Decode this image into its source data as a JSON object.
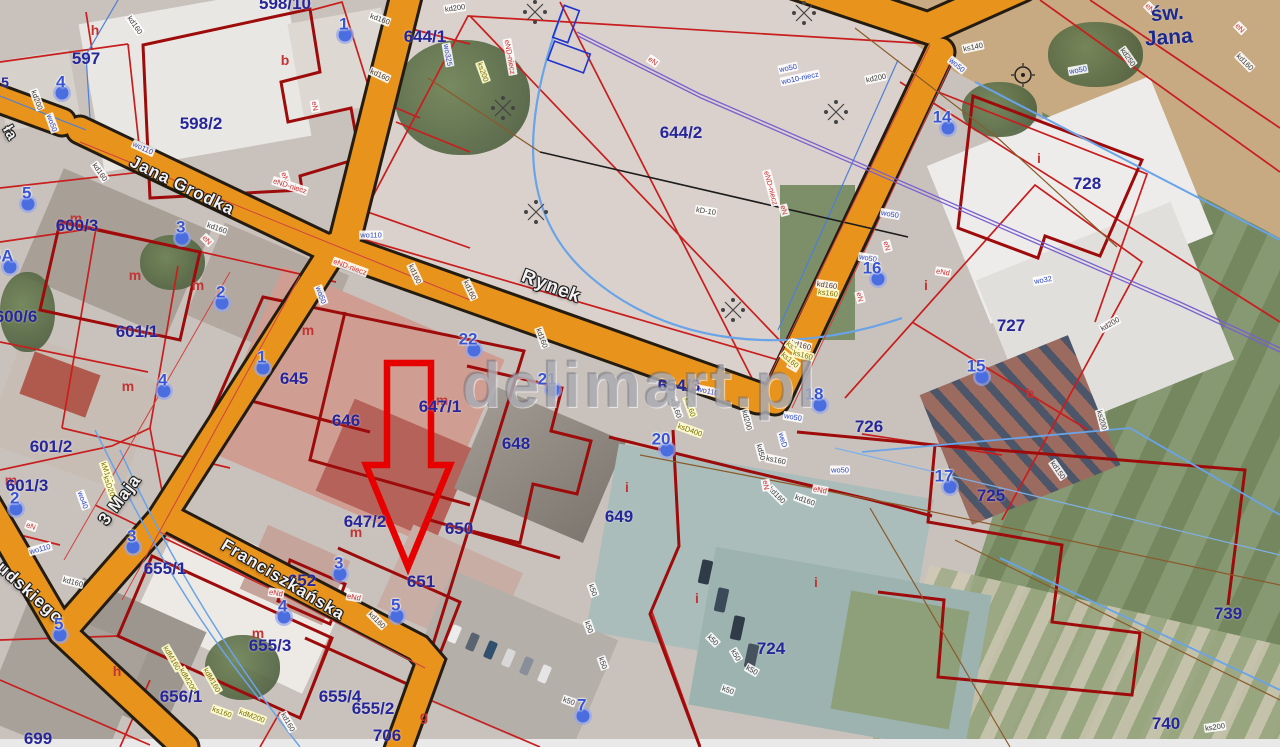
{
  "watermark": "delimart.pl",
  "colors": {
    "road": "#E8941C",
    "road-casing": "#241c10",
    "parcel": "#C81E1E",
    "parcel-dark": "#9E0B0B",
    "parcel-text": "#26269A",
    "marker": "#4a6ee0",
    "marker-text": "#3A55D4",
    "street-text": "#F2F2F2",
    "arrow": "#E60000",
    "letter": "#C23535",
    "watermark": "rgba(135,137,148,0.5)"
  },
  "streets": [
    {
      "t": "Jana Grodka",
      "x": 182,
      "y": 186,
      "r": 26,
      "s": 17,
      "k": "road"
    },
    {
      "t": "Rynek",
      "x": 551,
      "y": 287,
      "r": 21,
      "s": 19,
      "k": "road"
    },
    {
      "t": "3 Maja",
      "x": 120,
      "y": 500,
      "r": -53,
      "s": 17,
      "k": "road"
    },
    {
      "t": "Franciszkańska",
      "x": 283,
      "y": 580,
      "r": 31,
      "s": 17,
      "k": "road"
    },
    {
      "t": "udskiego",
      "x": 30,
      "y": 593,
      "r": 42,
      "s": 17,
      "k": "road"
    },
    {
      "t": "ła",
      "x": 10,
      "y": 133,
      "r": 60,
      "s": 15,
      "k": "road"
    },
    {
      "t": "św.\nJana",
      "x": 1168,
      "y": 26,
      "r": -4,
      "s": 21,
      "k": "navy"
    }
  ],
  "parcels": [
    {
      "t": "597",
      "x": 86,
      "y": 59
    },
    {
      "t": "598/2",
      "x": 201,
      "y": 124
    },
    {
      "t": "598/10",
      "x": 285,
      "y": 4
    },
    {
      "t": "600/3",
      "x": 77,
      "y": 226
    },
    {
      "t": "600/6",
      "x": 16,
      "y": 317
    },
    {
      "t": "601/1",
      "x": 137,
      "y": 332
    },
    {
      "t": "601/2",
      "x": 51,
      "y": 447
    },
    {
      "t": "601/3",
      "x": 27,
      "y": 486
    },
    {
      "t": "645",
      "x": 294,
      "y": 379
    },
    {
      "t": "646",
      "x": 346,
      "y": 421
    },
    {
      "t": "644/2",
      "x": 681,
      "y": 133
    },
    {
      "t": "644/1",
      "x": 425,
      "y": 37
    },
    {
      "t": "654/3",
      "x": 679,
      "y": 386
    },
    {
      "t": "647/1",
      "x": 440,
      "y": 407
    },
    {
      "t": "648",
      "x": 516,
      "y": 444
    },
    {
      "t": "647/2",
      "x": 365,
      "y": 522
    },
    {
      "t": "650",
      "x": 459,
      "y": 529
    },
    {
      "t": "651",
      "x": 421,
      "y": 582
    },
    {
      "t": "649",
      "x": 619,
      "y": 517
    },
    {
      "t": "652",
      "x": 302,
      "y": 581
    },
    {
      "t": "655/1",
      "x": 165,
      "y": 569
    },
    {
      "t": "655/3",
      "x": 270,
      "y": 646
    },
    {
      "t": "655/4",
      "x": 340,
      "y": 697
    },
    {
      "t": "655/2",
      "x": 373,
      "y": 709
    },
    {
      "t": "656/1",
      "x": 181,
      "y": 697
    },
    {
      "t": "699",
      "x": 38,
      "y": 739
    },
    {
      "t": "706",
      "x": 387,
      "y": 736
    },
    {
      "t": "724",
      "x": 771,
      "y": 649
    },
    {
      "t": "725",
      "x": 991,
      "y": 496
    },
    {
      "t": "726",
      "x": 869,
      "y": 427
    },
    {
      "t": "727",
      "x": 1011,
      "y": 326
    },
    {
      "t": "728",
      "x": 1087,
      "y": 184
    },
    {
      "t": "739",
      "x": 1228,
      "y": 614
    },
    {
      "t": "740",
      "x": 1166,
      "y": 724
    },
    {
      "t": "5",
      "x": 5,
      "y": 82,
      "s": 14
    }
  ],
  "markers": [
    {
      "n": "1",
      "x": 345,
      "y": 35
    },
    {
      "n": "4",
      "x": 62,
      "y": 93
    },
    {
      "n": "5",
      "x": 28,
      "y": 204
    },
    {
      "n": "5A",
      "x": 10,
      "y": 267
    },
    {
      "n": "3",
      "x": 182,
      "y": 238
    },
    {
      "n": "2",
      "x": 222,
      "y": 303
    },
    {
      "n": "4",
      "x": 164,
      "y": 391
    },
    {
      "n": "1",
      "x": 263,
      "y": 368
    },
    {
      "n": "2",
      "x": 16,
      "y": 509
    },
    {
      "n": "3",
      "x": 133,
      "y": 547
    },
    {
      "n": "5",
      "x": 60,
      "y": 635
    },
    {
      "n": "3",
      "x": 340,
      "y": 574
    },
    {
      "n": "4",
      "x": 284,
      "y": 617
    },
    {
      "n": "5",
      "x": 397,
      "y": 616
    },
    {
      "n": "22",
      "x": 474,
      "y": 350
    },
    {
      "n": "21",
      "x": 553,
      "y": 390
    },
    {
      "n": "20",
      "x": 667,
      "y": 450
    },
    {
      "n": "18",
      "x": 820,
      "y": 405
    },
    {
      "n": "16",
      "x": 878,
      "y": 279
    },
    {
      "n": "14",
      "x": 948,
      "y": 128
    },
    {
      "n": "15",
      "x": 982,
      "y": 377
    },
    {
      "n": "17",
      "x": 950,
      "y": 487
    },
    {
      "n": "7",
      "x": 583,
      "y": 716
    }
  ],
  "letters": [
    {
      "t": "h",
      "x": 95,
      "y": 30
    },
    {
      "t": "b",
      "x": 285,
      "y": 60
    },
    {
      "t": "m",
      "x": 76,
      "y": 218
    },
    {
      "t": "m",
      "x": 135,
      "y": 275
    },
    {
      "t": "m",
      "x": 198,
      "y": 285
    },
    {
      "t": "m",
      "x": 308,
      "y": 330
    },
    {
      "t": "m",
      "x": 128,
      "y": 386
    },
    {
      "t": "m",
      "x": 442,
      "y": 400
    },
    {
      "t": "b",
      "x": 1030,
      "y": 393
    },
    {
      "t": "i",
      "x": 1039,
      "y": 158
    },
    {
      "t": "i",
      "x": 926,
      "y": 285
    },
    {
      "t": "i",
      "x": 627,
      "y": 487
    },
    {
      "t": "i",
      "x": 697,
      "y": 598
    },
    {
      "t": "i",
      "x": 816,
      "y": 582
    },
    {
      "t": "m",
      "x": 356,
      "y": 532
    },
    {
      "t": "m",
      "x": 258,
      "y": 633
    },
    {
      "t": "h",
      "x": 117,
      "y": 671
    },
    {
      "t": "g",
      "x": 424,
      "y": 716
    },
    {
      "t": "m",
      "x": 11,
      "y": 480
    }
  ],
  "utilities": [
    {
      "t": "kd200",
      "x": 455,
      "y": 8,
      "r": -8,
      "c": "d"
    },
    {
      "t": "kd160",
      "x": 135,
      "y": 25,
      "r": 55,
      "c": "d"
    },
    {
      "t": "kd160",
      "x": 380,
      "y": 19,
      "r": 20,
      "c": "d"
    },
    {
      "t": "kd160",
      "x": 380,
      "y": 75,
      "r": 25,
      "c": "d"
    },
    {
      "t": "kd200",
      "x": 37,
      "y": 100,
      "r": 70,
      "c": "d"
    },
    {
      "t": "kd160",
      "x": 100,
      "y": 172,
      "r": 55,
      "c": "d"
    },
    {
      "t": "kd160",
      "x": 217,
      "y": 228,
      "r": 20,
      "c": "d"
    },
    {
      "t": "kd160",
      "x": 415,
      "y": 274,
      "r": 65,
      "c": "d"
    },
    {
      "t": "kd160",
      "x": 470,
      "y": 290,
      "r": 65,
      "c": "d"
    },
    {
      "t": "kd160",
      "x": 542,
      "y": 338,
      "r": 70,
      "c": "d"
    },
    {
      "t": "kD-10",
      "x": 706,
      "y": 211,
      "r": 9,
      "c": "d"
    },
    {
      "t": "kd200",
      "x": 876,
      "y": 78,
      "r": -12,
      "c": "d"
    },
    {
      "t": "ks140",
      "x": 973,
      "y": 47,
      "r": -12,
      "c": "d"
    },
    {
      "t": "kd250",
      "x": 1128,
      "y": 57,
      "r": 55,
      "c": "d"
    },
    {
      "t": "kd160",
      "x": 1245,
      "y": 62,
      "r": 45,
      "c": "d"
    },
    {
      "t": "kd200",
      "x": 1110,
      "y": 324,
      "r": -30,
      "c": "d"
    },
    {
      "t": "ks200",
      "x": 1102,
      "y": 420,
      "r": 75,
      "c": "d"
    },
    {
      "t": "kd150",
      "x": 1058,
      "y": 470,
      "r": 55,
      "c": "d"
    },
    {
      "t": "ks200",
      "x": 1215,
      "y": 727,
      "r": -8,
      "c": "d"
    },
    {
      "t": "kd160",
      "x": 676,
      "y": 408,
      "r": 70,
      "c": "d"
    },
    {
      "t": "kd200",
      "x": 747,
      "y": 420,
      "r": 75,
      "c": "d"
    },
    {
      "t": "kd160",
      "x": 805,
      "y": 500,
      "r": 20,
      "c": "d"
    },
    {
      "t": "kd160",
      "x": 827,
      "y": 285,
      "r": 8,
      "c": "d"
    },
    {
      "t": "kd160",
      "x": 801,
      "y": 345,
      "r": 15,
      "c": "d"
    },
    {
      "t": "kd50",
      "x": 761,
      "y": 452,
      "r": 75,
      "c": "d"
    },
    {
      "t": "kd160",
      "x": 377,
      "y": 620,
      "r": 45,
      "c": "d"
    },
    {
      "t": "kd160",
      "x": 73,
      "y": 582,
      "r": 15,
      "c": "d"
    },
    {
      "t": "kd160",
      "x": 288,
      "y": 722,
      "r": 60,
      "c": "d"
    },
    {
      "t": "kd160",
      "x": 777,
      "y": 495,
      "r": 45,
      "c": "d"
    },
    {
      "t": "ks160",
      "x": 776,
      "y": 460,
      "r": 12,
      "c": "d"
    },
    {
      "t": "k50",
      "x": 593,
      "y": 590,
      "r": 70,
      "c": "d"
    },
    {
      "t": "k50",
      "x": 589,
      "y": 627,
      "r": 70,
      "c": "d"
    },
    {
      "t": "k50",
      "x": 603,
      "y": 663,
      "r": 70,
      "c": "d"
    },
    {
      "t": "k50",
      "x": 569,
      "y": 701,
      "r": 20,
      "c": "d"
    },
    {
      "t": "k50",
      "x": 713,
      "y": 640,
      "r": 45,
      "c": "d"
    },
    {
      "t": "k50",
      "x": 736,
      "y": 655,
      "r": 60,
      "c": "d"
    },
    {
      "t": "k50",
      "x": 752,
      "y": 670,
      "r": 30,
      "c": "d"
    },
    {
      "t": "k50",
      "x": 728,
      "y": 690,
      "r": 20,
      "c": "d"
    },
    {
      "t": "eN",
      "x": 315,
      "y": 106,
      "r": 80,
      "c": "r"
    },
    {
      "t": "eN",
      "x": 285,
      "y": 177,
      "r": 75,
      "c": "r"
    },
    {
      "t": "eND-niecz",
      "x": 290,
      "y": 186,
      "r": 18,
      "c": "r"
    },
    {
      "t": "eN",
      "x": 207,
      "y": 240,
      "r": 45,
      "c": "r"
    },
    {
      "t": "eND-niecz",
      "x": 510,
      "y": 57,
      "r": 80,
      "c": "r"
    },
    {
      "t": "eN",
      "x": 653,
      "y": 61,
      "r": 35,
      "c": "r"
    },
    {
      "t": "eND-niecz",
      "x": 771,
      "y": 188,
      "r": 75,
      "c": "r"
    },
    {
      "t": "eN",
      "x": 784,
      "y": 210,
      "r": 75,
      "c": "r"
    },
    {
      "t": "eND-niecz",
      "x": 350,
      "y": 267,
      "r": 20,
      "c": "r"
    },
    {
      "t": "eN",
      "x": 887,
      "y": 246,
      "r": 75,
      "c": "r"
    },
    {
      "t": "eN",
      "x": 860,
      "y": 297,
      "r": 75,
      "c": "r"
    },
    {
      "t": "eN",
      "x": 793,
      "y": 366,
      "r": 30,
      "c": "r"
    },
    {
      "t": "eNd",
      "x": 943,
      "y": 272,
      "r": 10,
      "c": "r"
    },
    {
      "t": "eN",
      "x": 1240,
      "y": 28,
      "r": 45,
      "c": "r"
    },
    {
      "t": "eN",
      "x": 1150,
      "y": 8,
      "r": 45,
      "c": "r"
    },
    {
      "t": "eNd",
      "x": 276,
      "y": 593,
      "r": 10,
      "c": "r"
    },
    {
      "t": "eNd",
      "x": 354,
      "y": 597,
      "r": 10,
      "c": "r"
    },
    {
      "t": "eN",
      "x": 31,
      "y": 526,
      "r": 20,
      "c": "r"
    },
    {
      "t": "eNd",
      "x": 820,
      "y": 490,
      "r": 10,
      "c": "r"
    },
    {
      "t": "eN",
      "x": 766,
      "y": 485,
      "r": 80,
      "c": "r"
    },
    {
      "t": "wo110",
      "x": 143,
      "y": 148,
      "r": 25,
      "c": "b"
    },
    {
      "t": "wo50",
      "x": 52,
      "y": 123,
      "r": 70,
      "c": "b"
    },
    {
      "t": "wo110",
      "x": 371,
      "y": 235,
      "r": 0,
      "c": "b"
    },
    {
      "t": "wo50",
      "x": 321,
      "y": 295,
      "r": 70,
      "c": "b"
    },
    {
      "t": "wo50",
      "x": 788,
      "y": 68,
      "r": -12,
      "c": "b"
    },
    {
      "t": "wo10-niecz",
      "x": 800,
      "y": 78,
      "r": -12,
      "c": "b"
    },
    {
      "t": "wo110",
      "x": 708,
      "y": 391,
      "r": 12,
      "c": "b"
    },
    {
      "t": "wo50",
      "x": 793,
      "y": 417,
      "r": 10,
      "c": "b"
    },
    {
      "t": "weD",
      "x": 783,
      "y": 440,
      "r": 75,
      "c": "b"
    },
    {
      "t": "wo50",
      "x": 890,
      "y": 214,
      "r": 10,
      "c": "b"
    },
    {
      "t": "wo50",
      "x": 868,
      "y": 258,
      "r": 10,
      "c": "b"
    },
    {
      "t": "wo50",
      "x": 1078,
      "y": 70,
      "r": -10,
      "c": "b"
    },
    {
      "t": "wo32",
      "x": 1043,
      "y": 280,
      "r": -10,
      "c": "b"
    },
    {
      "t": "wo110",
      "x": 40,
      "y": 549,
      "r": -15,
      "c": "b"
    },
    {
      "t": "wo40",
      "x": 83,
      "y": 500,
      "r": 70,
      "c": "b"
    },
    {
      "t": "wo50",
      "x": 840,
      "y": 470,
      "r": 0,
      "c": "b"
    },
    {
      "t": "wo50",
      "x": 957,
      "y": 65,
      "r": 40,
      "c": "b"
    },
    {
      "t": "wo325",
      "x": 448,
      "y": 55,
      "r": 80,
      "c": "b"
    },
    {
      "t": "ks200",
      "x": 483,
      "y": 72,
      "r": 70,
      "c": "o"
    },
    {
      "t": "ks160",
      "x": 795,
      "y": 349,
      "r": 40,
      "c": "o"
    },
    {
      "t": "ks160",
      "x": 790,
      "y": 360,
      "r": 40,
      "c": "o"
    },
    {
      "t": "ksD400",
      "x": 690,
      "y": 430,
      "r": 20,
      "c": "o"
    },
    {
      "t": "ks160",
      "x": 690,
      "y": 407,
      "r": 70,
      "c": "o"
    },
    {
      "t": "kM160",
      "x": 107,
      "y": 473,
      "r": 70,
      "c": "o"
    },
    {
      "t": "ksD200",
      "x": 110,
      "y": 488,
      "r": 70,
      "c": "o"
    },
    {
      "t": "kdM160",
      "x": 172,
      "y": 658,
      "r": 60,
      "c": "o"
    },
    {
      "t": "kdM200",
      "x": 188,
      "y": 680,
      "r": 60,
      "c": "o"
    },
    {
      "t": "kdM160",
      "x": 212,
      "y": 680,
      "r": 60,
      "c": "o"
    },
    {
      "t": "ks160",
      "x": 222,
      "y": 712,
      "r": 20,
      "c": "o"
    },
    {
      "t": "kdM200",
      "x": 252,
      "y": 716,
      "r": 20,
      "c": "o"
    },
    {
      "t": "ks160",
      "x": 828,
      "y": 293,
      "r": 8,
      "c": "o"
    },
    {
      "t": "ks160",
      "x": 803,
      "y": 355,
      "r": 15,
      "c": "o"
    }
  ]
}
